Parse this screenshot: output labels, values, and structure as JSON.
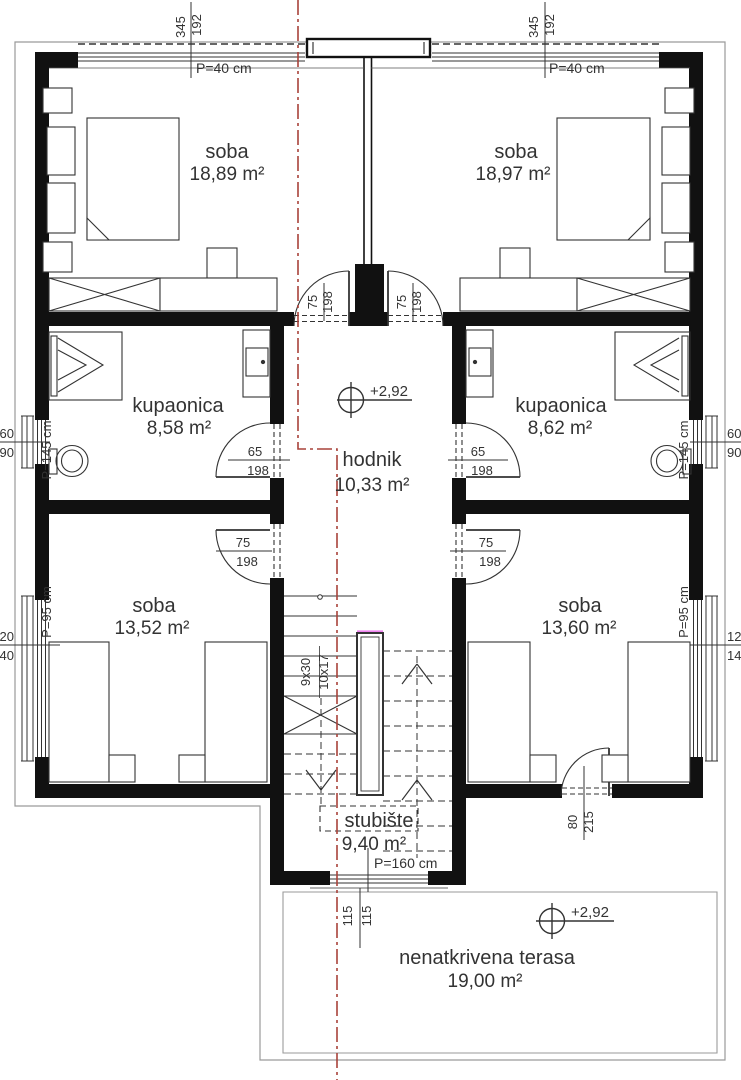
{
  "colors": {
    "wall": "#111111",
    "line": "#333333",
    "red_axis": "#a8423a",
    "magenta": "#ee82ee",
    "plot_line": "#9a9a9a"
  },
  "rooms": {
    "soba_tl": {
      "name": "soba",
      "area": "18,89 m²"
    },
    "soba_tr": {
      "name": "soba",
      "area": "18,97 m²"
    },
    "kupaonica_l": {
      "name": "kupaonica",
      "area": "8,58 m²"
    },
    "kupaonica_r": {
      "name": "kupaonica",
      "area": "8,62 m²"
    },
    "hodnik": {
      "name": "hodnik",
      "area": "10,33 m²"
    },
    "soba_bl": {
      "name": "soba",
      "area": "13,52 m²"
    },
    "soba_br": {
      "name": "soba",
      "area": "13,60 m²"
    },
    "stubiste": {
      "name": "stubište",
      "area": "9,40 m²"
    },
    "terasa": {
      "name": "nenatkrivena terasa",
      "area": "19,00 m²"
    }
  },
  "levels": {
    "hodnik": "+2,92",
    "terrace": "+2,92"
  },
  "window_labels": {
    "top_left": "P=40 cm",
    "top_right": "P=40 cm",
    "bath_left": "P=145 cm",
    "bath_right": "P=145 cm",
    "room_left": "P=95 cm",
    "room_right": "P=95 cm",
    "stair": "P=160 cm"
  },
  "dims": {
    "top_left": {
      "w": "345",
      "o": "192"
    },
    "top_right": {
      "w": "345",
      "o": "192"
    },
    "win_bath_left": {
      "w": "60",
      "h": "90"
    },
    "win_bath_right": {
      "w": "60",
      "h": "90"
    },
    "win_room_left": {
      "w": "120",
      "h": "140"
    },
    "win_room_right": {
      "w": "120",
      "h": "140"
    },
    "win_stair": {
      "a": "115",
      "b": "115"
    },
    "stair_flights": {
      "left": "9x30",
      "right": "10x17"
    },
    "door_top_left": {
      "w": "75",
      "h": "198"
    },
    "door_top_right": {
      "w": "75",
      "h": "198"
    },
    "door_bath_left": {
      "w": "65",
      "h": "198"
    },
    "door_bath_right": {
      "w": "65",
      "h": "198"
    },
    "door_room_left": {
      "w": "75",
      "h": "198"
    },
    "door_room_right": {
      "w": "75",
      "h": "198"
    },
    "door_terrace": {
      "w": "80",
      "h": "215"
    }
  }
}
